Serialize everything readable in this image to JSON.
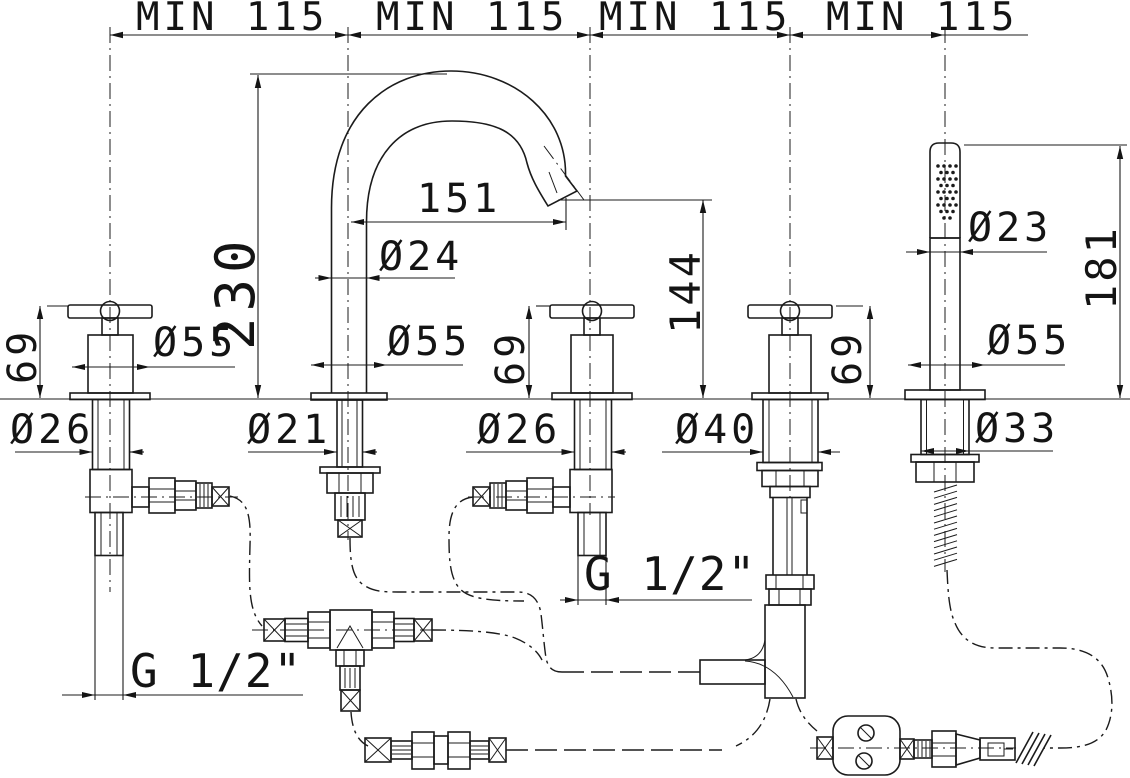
{
  "top_spacings": [
    "MIN 115",
    "MIN 115",
    "MIN 115",
    "MIN 115"
  ],
  "units": {
    "left_handle": {
      "height": "69",
      "base_diameter": "Ø55",
      "stem_diameter": "Ø26",
      "thread": "G 1/2\""
    },
    "spout": {
      "height": "230",
      "reach": "151",
      "tube_diameter": "Ø24",
      "base_diameter": "Ø55",
      "tail_diameter": "Ø21"
    },
    "right_handle": {
      "height": "69",
      "stem_diameter": "Ø26",
      "thread": "G 1/2\"",
      "outlet_height": "144"
    },
    "diverter": {
      "height": "69",
      "body_diameter": "Ø40"
    },
    "handshower": {
      "height": "181",
      "head_diameter": "Ø23",
      "base_diameter": "Ø55",
      "nut_diameter": "Ø33"
    }
  }
}
